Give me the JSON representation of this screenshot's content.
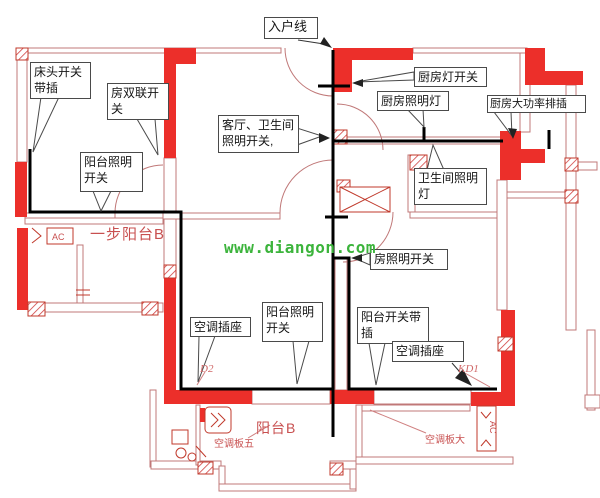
{
  "watermark": {
    "text": "www.diangon.com",
    "color": "#3cb43c"
  },
  "callouts": {
    "entry_line": {
      "text": "入户线"
    },
    "bedside": {
      "line1": "床头开关",
      "line2": "带插"
    },
    "room_double": {
      "line1": "房双联开",
      "line2": "关"
    },
    "living_bath": {
      "line1": "客厅、卫生间",
      "line2": "照明开关,"
    },
    "kitchen_switch": {
      "text": "厨房灯开关"
    },
    "kitchen_light": {
      "text": "厨房照明灯"
    },
    "kitchen_strip": {
      "text": "厨房大功率排插"
    },
    "bath_light": {
      "line1": "卫生间照明",
      "line2": "灯"
    },
    "room_light_switch": {
      "text": "房照明开关"
    },
    "balcony_light_left": {
      "line1": "阳台照明",
      "line2": "开关"
    },
    "ac_socket_left": {
      "text": "空调插座"
    },
    "balcony_light_right": {
      "line1": "阳台照明",
      "line2": "开关"
    },
    "balcony_switch_socket": {
      "line1": "阳台开关带",
      "line2": "插"
    },
    "ac_socket_right": {
      "text": "空调插座"
    }
  },
  "plan_labels": {
    "step_balcony": "一步阳台B",
    "balcony_b": "阳台B",
    "ac_panel_five": "空调板五",
    "ac_panel_big": "空调板大",
    "d2": "D2",
    "kd1": "KD1",
    "ac_left": "AC",
    "ac_right": "AC"
  },
  "colors": {
    "wall_red": "#ec2f2a",
    "wall_line": "#c07878",
    "wire_black": "#000000",
    "label_red": "#c85050",
    "watermark_green": "#3cb43c"
  }
}
